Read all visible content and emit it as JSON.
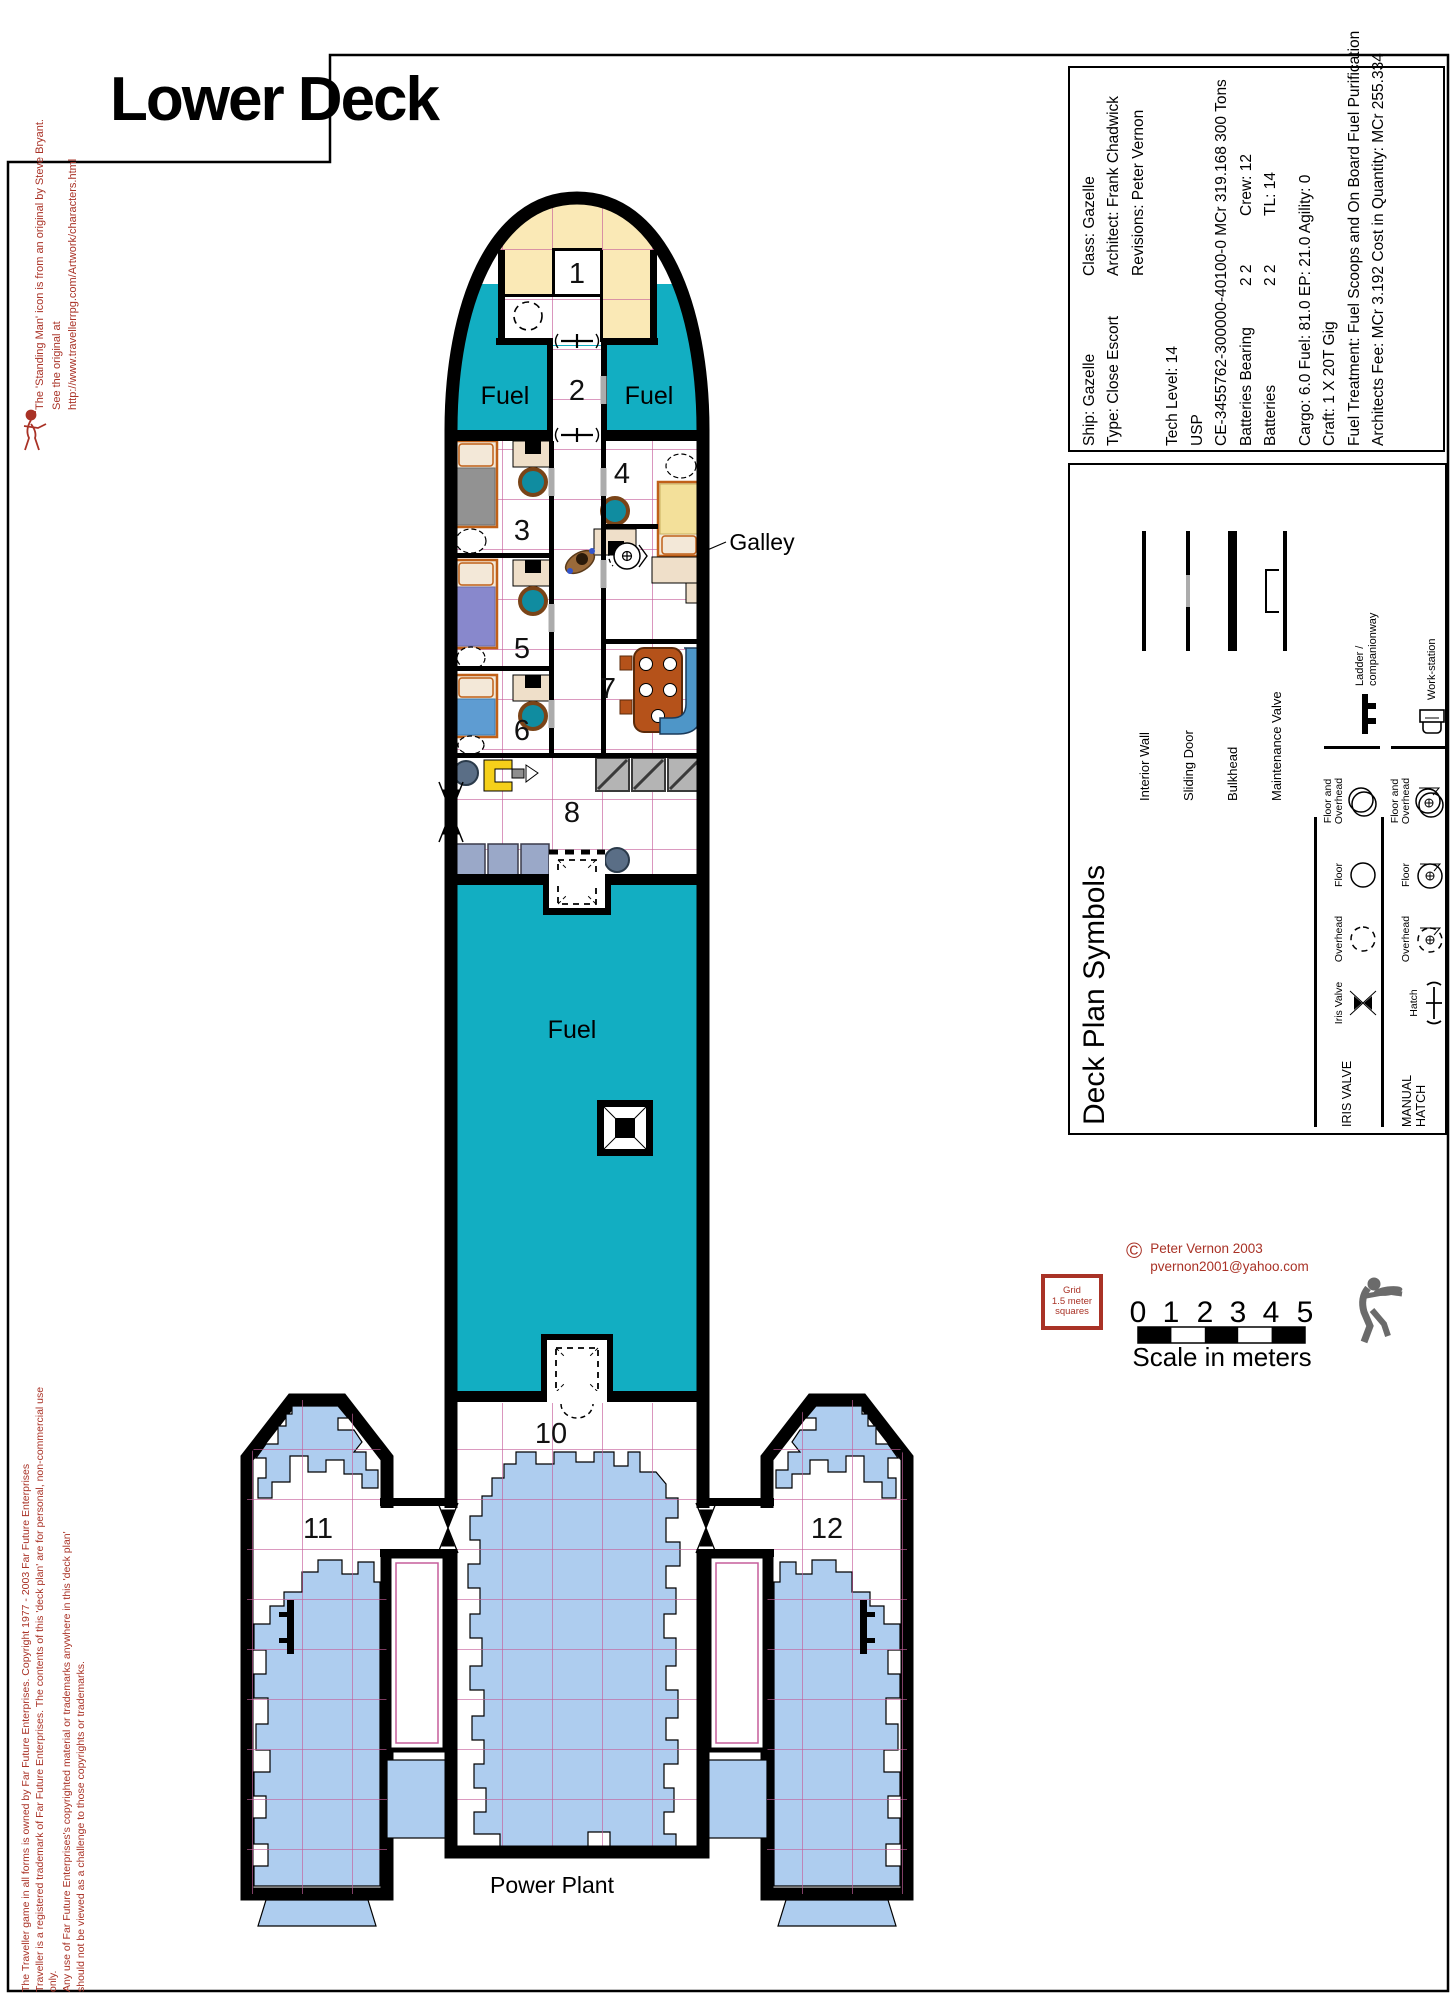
{
  "title": "Lower Deck",
  "colors": {
    "fuel_teal": "#12AEC2",
    "nose_cream": "#FAE9B6",
    "machinery_blue": "#AECDEF",
    "grid_pink": "#C55E9B",
    "accent_red": "#A93226",
    "bench_blue": "#4E96C8",
    "table_brown": "#B5521A",
    "chair_teal": "#108CA0"
  },
  "plan": {
    "rooms": {
      "r1": "1",
      "r2": "2",
      "r3": "3",
      "r4": "4",
      "r5": "5",
      "r6": "6",
      "r7": "7",
      "r8": "8",
      "r10": "10",
      "r11": "11",
      "r12": "12"
    },
    "labels": {
      "fuel_left": "Fuel",
      "fuel_right": "Fuel",
      "fuel_main": "Fuel",
      "galley": "Galley",
      "power_plant": "Power Plant"
    }
  },
  "info_box": {
    "line1_left": "Ship: Gazelle",
    "line1_right": "Class: Gazelle",
    "line2_left": "Type: Close Escort",
    "line2_right": "Architect: Frank Chadwick",
    "line3_right": "Revisions: Peter Vernon",
    "line4": "Tech Level: 14",
    "line5": "USP",
    "line6": "CE-3455762-300000-40100-0 MCr 319.168 300 Tons",
    "line7_left": "Batteries Bearing",
    "line7_mid": "2 2",
    "line7_right": "Crew: 12",
    "line8_left": "Batteries",
    "line8_mid": "2 2",
    "line8_right": "TL: 14",
    "line9": "Cargo: 6.0  Fuel: 81.0  EP: 21.0  Agility: 0",
    "line10": "Craft: 1 X 20T Gig",
    "line11": "Fuel Treatment: Fuel Scoops and On Board Fuel Purification",
    "line12": "Architects Fee: MCr 3.192  Cost in Quantity: MCr 255.334"
  },
  "legend": {
    "title": "Deck Plan Symbols",
    "walls": {
      "interior_wall": "Interior Wall",
      "sliding_door": "Sliding Door",
      "bulkhead": "Bulkhead",
      "maintenance_valve": "Maintenance Valve"
    },
    "iris": {
      "header": "IRIS VALVE",
      "iris_valve": "Iris Valve",
      "overhead": "Overhead",
      "floor": "Floor",
      "floor_overhead": "Floor and Overhead",
      "ladder_1": "Ladder /",
      "ladder_2": "companionway"
    },
    "manual": {
      "header": "MANUAL HATCH",
      "hatch": "Hatch",
      "overhead": "Overhead",
      "floor": "Floor",
      "floor_overhead": "Floor and Overhead",
      "workstation": "Work-station"
    }
  },
  "scale_bar": {
    "ticks": [
      "0",
      "1",
      "2",
      "3",
      "4",
      "5"
    ],
    "caption": "Scale in meters"
  },
  "grid_note": {
    "line1": "Grid",
    "line2": "1.5 meter",
    "line3": "squares"
  },
  "credits": {
    "copyright_symbol": "©",
    "author_line1": "Peter Vernon 2003",
    "author_line2": "pvernon2001@yahoo.com",
    "standing_man_line1": "The 'Standing Man' icon is from an original by Steve Bryant.",
    "standing_man_line2": "See the original at http://www.travellerrpg.com/Artwork/characters.html",
    "ffe_line1": "The Traveller game in all forms is owned by Far Future Enterprises. Copyright 1977 - 2003 Far Future Enterprises",
    "ffe_line2": "Traveller is a registered trademark of Far Future Enterprises. The contents of this 'deck plan' are for personal, non-commercial use only.",
    "ffe_line3": "Any use of Far Future Enterprises's copyrighted material or trademarks anywhere in this 'deck plan'",
    "ffe_line4": "should not be viewed as a challenge to those copyrights or trademarks."
  }
}
